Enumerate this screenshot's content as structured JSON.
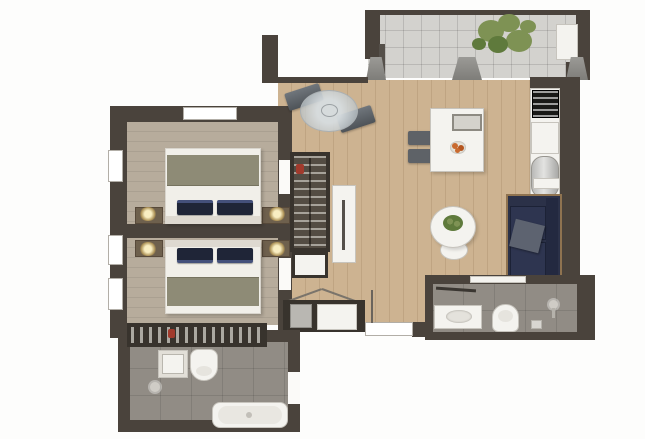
{
  "meta": {
    "type": "apartment-floor-plan",
    "view": "top-down-3d-render",
    "canvas": {
      "width": 645,
      "height": 439
    },
    "visible_text": "none"
  },
  "palette": {
    "wall": "#4a433c",
    "wood": "#cdb391",
    "bedfloor": "#b7ac9c",
    "tile": "#d3d2ce",
    "bath": "#918c85",
    "fixture": "#f4f3ef",
    "fixborder": "#c7c4bd",
    "navy": "#2b3148",
    "navydark": "#232940",
    "frame": "#8f7350",
    "graypillow": "#5d6370",
    "blanket": "#8e8b76",
    "bedwhite": "#f1efe9",
    "pillow": "#1f2537",
    "chair": "#5e6267",
    "glass": "#ccd2d5",
    "green": "#7e9254",
    "greendark": "#5f7a3c",
    "orange": "#c96a2f",
    "dark": "#38332d",
    "red": "#a13a2c"
  },
  "rooms": [
    {
      "id": "terrace",
      "label": "terrace",
      "furniture": [
        "potted-plant",
        "storage-unit",
        "sliding-door-panels"
      ]
    },
    {
      "id": "living-room",
      "label": "living-dining-room",
      "furniture": [
        "dining-table",
        "dining-chairs",
        "serving-tray",
        "fruit-bowl",
        "glass-bistro-table",
        "bench-seats",
        "sofa",
        "throw-pillow",
        "side-shelf",
        "round-coffee-table",
        "table-plant"
      ]
    },
    {
      "id": "kitchen",
      "label": "kitchenette",
      "furniture": [
        "cooktop",
        "counter-front",
        "sink-unit"
      ]
    },
    {
      "id": "hallway",
      "label": "hall-dressing-area",
      "furniture": [
        "open-wardrobe",
        "shelf-unit",
        "sideboard",
        "console-cabinet",
        "open-door-leaf"
      ]
    },
    {
      "id": "bedroom-1",
      "label": "bedroom-1",
      "furniture": [
        "double-bed",
        "nightstand-left",
        "nightstand-right",
        "table-lamps"
      ]
    },
    {
      "id": "bedroom-2",
      "label": "bedroom-2",
      "furniture": [
        "double-bed",
        "nightstand-left",
        "nightstand-right",
        "table-lamps"
      ]
    },
    {
      "id": "bathroom-1",
      "label": "main-bathroom",
      "furniture": [
        "wardrobe-counter",
        "vanity-basin",
        "toilet",
        "shower-fixture",
        "bathtub"
      ]
    },
    {
      "id": "bathroom-2",
      "label": "shower-room",
      "furniture": [
        "wall-shelf",
        "vanity-basin",
        "toilet",
        "shower-fixture",
        "bath-mat"
      ]
    }
  ]
}
